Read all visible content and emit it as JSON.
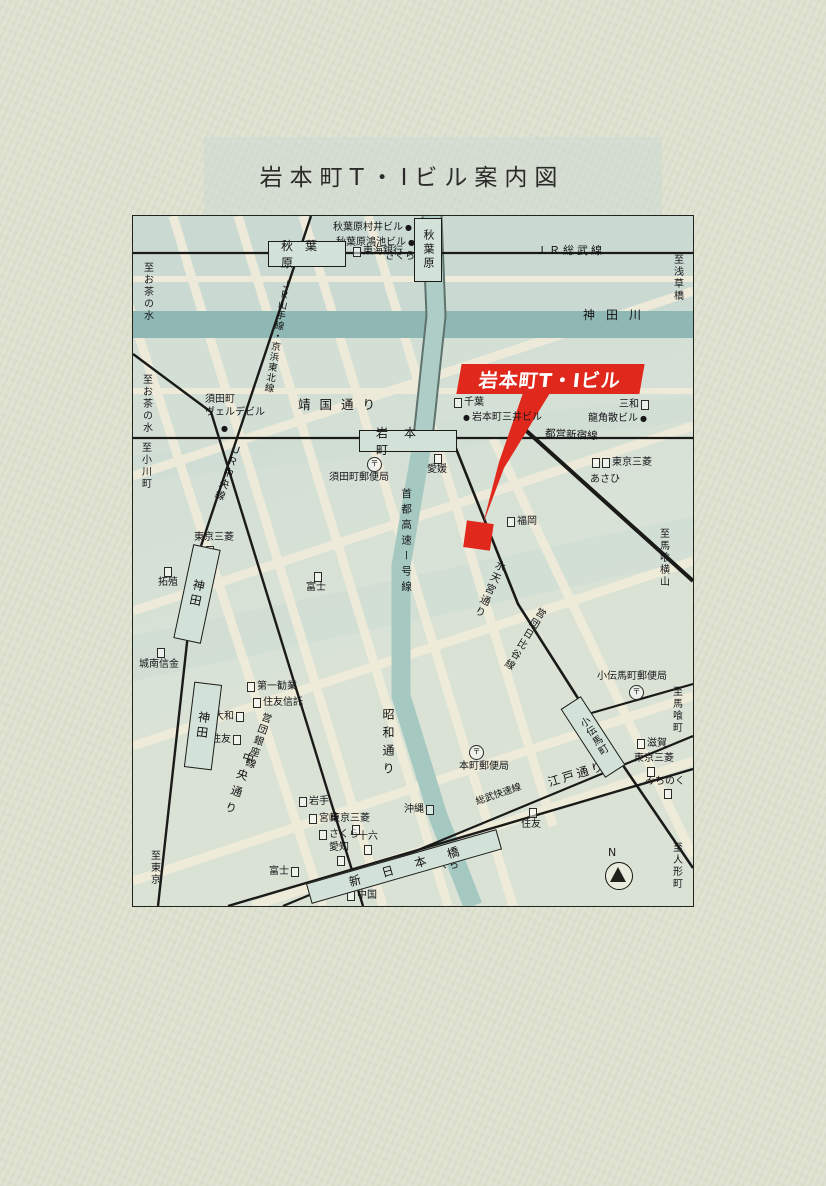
{
  "title": "岩本町T・Iビル案内図",
  "highlight": {
    "label": "岩本町T・Iビル",
    "color": "#e0281c"
  },
  "stations": {
    "akihabara_jr": "秋葉原",
    "akihabara_showa": "秋葉原",
    "iwamotocho": "岩本町",
    "kanda_jr": "神田",
    "kanda_metro": "神田",
    "kodenmacho": "小伝馬町",
    "shin_nihombashi": "新日本橋"
  },
  "lines": {
    "jr_sobu": "ＪＲ総武線",
    "jr_yamanote_keihin": "ＪＲ山手線・京浜東北線",
    "jr_chuo": "ＪＲ中央線",
    "toei_shinjuku": "都営新宿線",
    "eidan_ginza": "営団銀座線",
    "eidan_hibiya": "営団日比谷線",
    "sobu_rapid": "総武快速線"
  },
  "roads": {
    "yasukuni": "靖国通り",
    "chuo": "中央通り",
    "showa": "昭和通り",
    "shuto_expwy": "首都高速ー号線",
    "suitengu": "水天宮通り",
    "edo": "江戸通り"
  },
  "river": {
    "kanda_river": "神田川"
  },
  "directions": {
    "ochanomizu_1": "至お茶の水",
    "ochanomizu_2": "至お茶の水",
    "ogawamachi": "至小川町",
    "asakusabashi": "至浅草橋",
    "bakuroyokoyama": "至馬喰横山",
    "bakurocho": "至馬喰町",
    "ningyocho": "至人形町",
    "tokyo": "至東京"
  },
  "buildings": {
    "murai": "秋葉原村井ビル",
    "konoike": "秋葉原鴻池ビル",
    "verde_l1": "須田町",
    "verde_l2": "ヴェルデビル",
    "mitsui": "岩本町三井ビル",
    "ryukakusan": "龍角散ビル"
  },
  "banks": {
    "sakura_akiba": "さくら",
    "tokai": "東海銀行",
    "chiba": "千葉",
    "sanwa": "三和",
    "tokyo_mitsubishi_e": "東京三菱",
    "asahi": "あさひ",
    "ehime": "愛媛",
    "fukuoka": "福岡",
    "tokyo_mitsubishi_kanda": "東京三菱",
    "takushoku": "拓殖",
    "jonan": "城南信金",
    "fuji_c": "富士",
    "daiichi_kangyo": "第一勧業",
    "sumitomo_trust": "住友信託",
    "daiwa": "大和",
    "sumitomo_w": "住友",
    "iwate": "岩手",
    "miyazaki": "宮崎",
    "sakura_sw": "さくら",
    "aichi": "愛知",
    "juroku": "十六",
    "tokyo_mitsubishi_s": "東京三菱",
    "okinawa": "沖縄",
    "fuji_s": "富士",
    "sakura_se": "さくら",
    "chugoku": "中国",
    "shiga": "滋賀",
    "tokyo_mitsubishi_k": "東京三菱",
    "michinoku": "みちのく",
    "sumitomo_e": "住友"
  },
  "post": {
    "symbol": "〒",
    "sudacho": "須田町郵便局",
    "honcho": "本町郵便局",
    "kodenmacho": "小伝馬町郵便局"
  },
  "compass": {
    "n": "N"
  },
  "dot": "●"
}
